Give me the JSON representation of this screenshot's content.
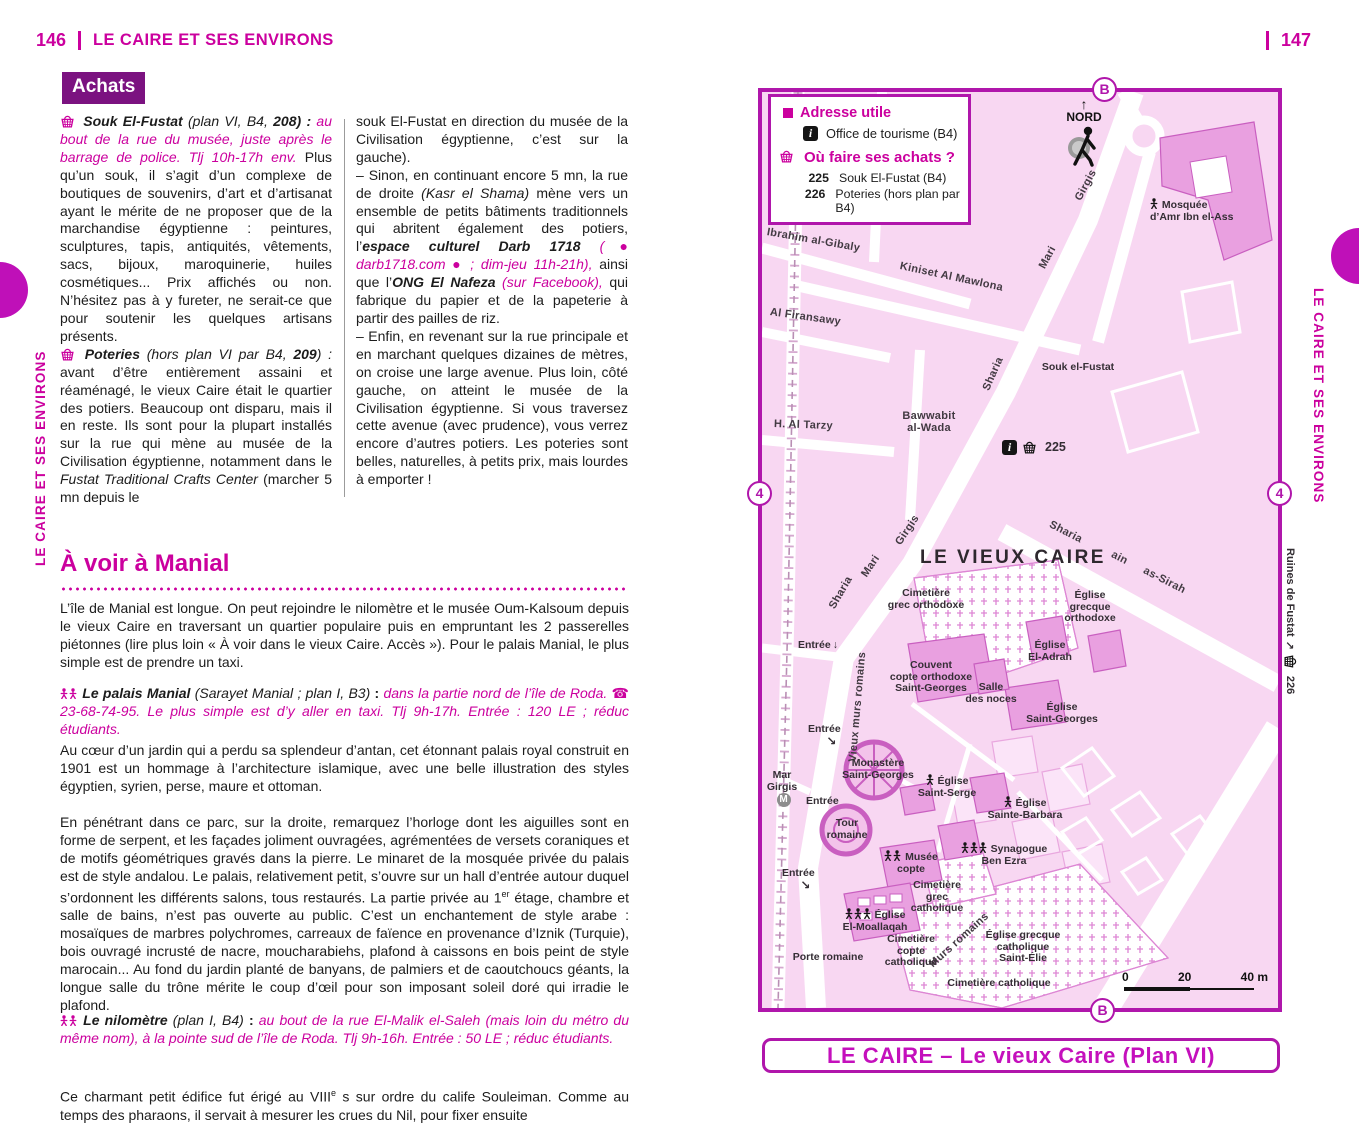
{
  "colors": {
    "accent_magenta": "#cb009e",
    "map_border": "#b016ab",
    "badge_purple": "#7b1280",
    "map_pink": "#f8d7f2"
  },
  "header_left": {
    "page": "146",
    "title": "LE CAIRE ET SES ENVIRONS"
  },
  "header_right": {
    "page": "147"
  },
  "margin_left": {
    "tab_text": "LE CAIRE ET SES ENVIRONS"
  },
  "margin_right": {
    "tab_text": "LE CAIRE ET SES ENVIRONS"
  },
  "achats": {
    "badge": "Achats",
    "col1": [
      [
        {
          "icon": "basket"
        },
        {
          "t": " Souk El-Fustat ",
          "s": "bi"
        },
        {
          "t": "(plan VI, B4, ",
          "s": "i"
        },
        {
          "t": "208",
          "s": "bi"
        },
        {
          "t": ") : ",
          "s": "bi"
        },
        {
          "t": "au bout de la rue du musée, juste après le barrage de police. Tlj 10h-17h env.",
          "s": "mi"
        },
        {
          "t": " Plus qu’un souk, il s’agit d’un complexe de boutiques de souvenirs, d’art et d’artisanat ayant le mérite de ne proposer que de la marchandise égyptienne : peintures, sculptures, tapis, antiquités, vêtements, sacs, bijoux, maroquinerie, huiles cosmétiques... Prix affichés ou non. N’hésitez pas à y fureter, ne serait-ce que pour soutenir les quelques artisans présents.",
          "s": "n"
        }
      ],
      [
        {
          "icon": "basket"
        },
        {
          "t": " Poteries ",
          "s": "bi"
        },
        {
          "t": "(hors plan VI par B4, ",
          "s": "i"
        },
        {
          "t": "209",
          "s": "bi"
        },
        {
          "t": ") : ",
          "s": "i"
        },
        {
          "t": "avant d’être entièrement assaini et réaménagé, le vieux Caire était le quartier des potiers. Beaucoup ont disparu, mais il en reste. Ils sont pour la plupart installés sur la rue qui mène au musée de la Civilisation égyptienne, notamment dans le ",
          "s": "n"
        },
        {
          "t": "Fustat Traditional Crafts Center",
          "s": "i"
        },
        {
          "t": " (marcher 5 mn depuis le",
          "s": "n"
        }
      ]
    ],
    "col2": [
      [
        {
          "t": "souk El-Fustat en direction du musée de la Civilisation égyptienne, c’est sur la gauche).",
          "s": "n"
        }
      ],
      [
        {
          "t": "– Sinon, en continuant encore 5 mn, la rue de droite ",
          "s": "n"
        },
        {
          "t": "(Kasr el Shama)",
          "s": "i"
        },
        {
          "t": " mène vers un ensemble de petits bâtiments traditionnels qui abritent également des potiers, l’",
          "s": "n"
        },
        {
          "t": "espace culturel Darb 1718",
          "s": "bi"
        },
        {
          "t": " (● darb1718.com ● ; dim-jeu 11h-21h),",
          "s": "mi"
        },
        {
          "t": " ainsi que l’",
          "s": "n"
        },
        {
          "t": "ONG El Nafeza",
          "s": "bi"
        },
        {
          "t": " (sur Facebook),",
          "s": "mi"
        },
        {
          "t": " qui fabrique du papier et de la papeterie à partir des pailles de riz.",
          "s": "n"
        }
      ],
      [
        {
          "t": "– Enfin, en revenant sur la rue principale et en marchant quelques dizaines de mètres, on croise une large avenue. Plus loin, côté gauche, on atteint le musée de la Civilisation égyptienne. Si vous traversez cette avenue (avec prudence), vous verrez encore d’autres potiers. Les poteries sont belles, naturelles, à petits prix, mais lourdes à emporter !",
          "s": "n"
        }
      ]
    ]
  },
  "manial": {
    "title": "À voir à Manial",
    "intro": [
      [
        {
          "t": "L’île de Manial est longue. On peut rejoindre le nilomètre et le musée Oum-Kalsoum depuis le vieux Caire en traversant un quartier populaire puis en empruntant les 2 passerelles piétonnes (lire plus loin « À voir dans le vieux Caire. Accès »). Pour le palais Manial, le plus simple est de prendre un taxi.",
          "s": "n"
        }
      ]
    ],
    "sight1": [
      [
        {
          "icon": "sights"
        },
        {
          "t": " Le palais Manial ",
          "s": "bi"
        },
        {
          "t": "(Sarayet Manial ; plan I, B3)",
          "s": "i"
        },
        {
          "t": " : ",
          "s": "b"
        },
        {
          "t": "dans la partie nord de l’île de Roda. ☎ 23-68-74-95. Le plus simple est d’y aller en taxi. Tlj 9h-17h. Entrée : 120 LE ; réduc étudiants.",
          "s": "mi"
        }
      ]
    ],
    "body1": [
      [
        {
          "t": "Au cœur d’un jardin qui a perdu sa splendeur d’antan, cet étonnant palais royal construit en 1901 est un hommage à l’architecture islamique, avec une belle illustration des styles égyptien, syrien, perse, maure et ottoman.",
          "s": "n"
        }
      ],
      [
        {
          "t": "En pénétrant dans ce parc, sur la droite, remarquez l’horloge dont les aiguilles sont en forme de serpent, et les façades joliment ouvragées, agrémentées de versets coraniques et de motifs géométriques gravés dans la pierre. Le minaret de la mosquée privée du palais est de style andalou. Le palais, relativement petit, s’ouvre sur un hall d’entrée autour duquel s’ordonnent les différents salons, tous restaurés. La partie privée au 1",
          "s": "n"
        },
        {
          "t": "er",
          "s": "sup"
        },
        {
          "t": " étage, chambre et salle de bains, n’est pas ouverte au public. C’est un enchantement de style arabe : mosaïques de marbres polychromes, carreaux de faïence en provenance d’Iznik (Turquie), bois ouvragé incrusté de nacre, moucharabiehs, plafond à caissons en bois peint de style marocain... Au fond du jardin planté de banyans, de palmiers et de caoutchoucs géants, la longue salle du trône mérite le coup d’œil pour son imposant soleil doré qui irradie le plafond.",
          "s": "n"
        }
      ]
    ],
    "sight2": [
      [
        {
          "icon": "sights"
        },
        {
          "t": " Le nilomètre ",
          "s": "bi"
        },
        {
          "t": "(plan I, B4)",
          "s": "i"
        },
        {
          "t": " : ",
          "s": "b"
        },
        {
          "t": "au bout de la rue El-Malik el-Saleh (mais loin du métro du même nom), à la pointe sud de l’île de Roda. Tlj 9h-16h. Entrée : 50 LE ; réduc étudiants.",
          "s": "mi"
        }
      ]
    ],
    "body2": [
      [
        {
          "t": "Ce charmant petit édifice fut érigé au VIII",
          "s": "n"
        },
        {
          "t": "e",
          "s": "sup"
        },
        {
          "t": " s sur ordre du calife Souleiman. Comme au temps des pharaons, il servait à mesurer les crues du Nil, pour fixer ensuite",
          "s": "n"
        }
      ]
    ]
  },
  "map": {
    "legend": {
      "address_title": "Adresse utile",
      "address_item": "Office de tourisme (B4)",
      "shopping_title": "Où faire ses achats ?",
      "shopping_items": [
        {
          "num": "225",
          "label": "Souk El-Fustat (B4)"
        },
        {
          "num": "226",
          "label": "Poteries (hors plan par B4)"
        }
      ]
    },
    "centre_ville_arrow": "↑",
    "centre_ville": "Centre-ville",
    "nord_arrow": "↑",
    "nord": "NORD",
    "marker_b": "B",
    "marker_4": "4",
    "scale": {
      "s0": "0",
      "s20": "20",
      "s40": "40 m"
    },
    "ruines": {
      "text": "Ruines de Fustat",
      "arrow": "↗",
      "num": "226"
    },
    "caption": "LE CAIRE – Le vieux Caire (Plan VI)",
    "labels": [
      {
        "t": "Ibrahim al-Gibaly",
        "x": 5,
        "y": 134,
        "r": 10,
        "c": "street"
      },
      {
        "t": "Kiniset  Al Mawlona",
        "x": 138,
        "y": 168,
        "r": 12,
        "c": "street"
      },
      {
        "t": "Al Firansawy",
        "x": 8,
        "y": 214,
        "r": 8,
        "c": "street"
      },
      {
        "t": "H.  Al  Tarzy",
        "x": 12,
        "y": 326,
        "r": 2,
        "c": "street"
      },
      {
        "t": "Bawwabit\nal-Wada",
        "x": 132,
        "y": 318,
        "r": 0,
        "c": "street",
        "w": 70,
        "ctr": true
      },
      {
        "t": "Girgis",
        "x": 316,
        "y": 102,
        "r": -62,
        "c": "street"
      },
      {
        "t": "Mari",
        "x": 280,
        "y": 170,
        "r": -62,
        "c": "street"
      },
      {
        "t": "Sharia",
        "x": 224,
        "y": 292,
        "r": -66,
        "c": "street"
      },
      {
        "t": "Sharia",
        "x": 288,
        "y": 426,
        "r": 27,
        "c": "street"
      },
      {
        "t": "ain",
        "x": 350,
        "y": 456,
        "r": 27,
        "c": "street"
      },
      {
        "t": "as-Sirah",
        "x": 382,
        "y": 472,
        "r": 27,
        "c": "street"
      },
      {
        "t": "Girgis",
        "x": 136,
        "y": 446,
        "r": -56,
        "c": "street"
      },
      {
        "t": "Mari",
        "x": 102,
        "y": 478,
        "r": -56,
        "c": "street"
      },
      {
        "t": "Sharia",
        "x": 70,
        "y": 510,
        "r": -60,
        "c": "street"
      },
      {
        "t": "Vieux murs romains",
        "x": 36,
        "y": 604,
        "r": -85,
        "c": "street",
        "w": 120
      },
      {
        "t": "Murs romains",
        "x": 156,
        "y": 834,
        "r": -42,
        "c": "street",
        "w": 100
      },
      {
        "t": "LE VIEUX CAIRE",
        "x": 158,
        "y": 456,
        "c": "title"
      },
      {
        "t": "Cimetière\ngrec orthodoxe",
        "x": 108,
        "y": 496,
        "c": "poi",
        "w": 112
      },
      {
        "t": "Église\ngrecque\northodoxe",
        "x": 292,
        "y": 498,
        "c": "poi",
        "w": 72
      },
      {
        "t": "Église\nEl-Adrah",
        "x": 252,
        "y": 548,
        "c": "poi",
        "w": 72
      },
      {
        "t": "Couvent\ncopte orthodoxe\nSaint-Georges",
        "x": 108,
        "y": 568,
        "c": "poi",
        "w": 122
      },
      {
        "t": "Salle\ndes noces",
        "x": 196,
        "y": 590,
        "c": "poi",
        "w": 66
      },
      {
        "t": "Église\nSaint-Georges",
        "x": 252,
        "y": 610,
        "c": "poi",
        "w": 96
      },
      {
        "t": "Monastère\nSaint-Georges",
        "x": 60,
        "y": 666,
        "c": "poi",
        "w": 112
      },
      {
        "t": "Église\nSaint-Serge",
        "x": 144,
        "y": 682,
        "c": "poi",
        "w": 82,
        "i": "p1"
      },
      {
        "t": "Église\nSainte-Barbara",
        "x": 212,
        "y": 704,
        "c": "poi",
        "w": 102,
        "i": "p1"
      },
      {
        "t": "Synagogue\nBen Ezra",
        "x": 196,
        "y": 750,
        "c": "poi",
        "w": 92,
        "i": "p3"
      },
      {
        "t": "Musée\ncopte",
        "x": 116,
        "y": 758,
        "c": "poi",
        "w": 66,
        "i": "p2"
      },
      {
        "t": "Tour\nromaine",
        "x": 54,
        "y": 726,
        "c": "poi",
        "w": 62
      },
      {
        "t": "Cimetière\ngrec\ncatholique",
        "x": 136,
        "y": 788,
        "c": "poi",
        "w": 78
      },
      {
        "t": "Église\nEl-Moallaqah",
        "x": 62,
        "y": 816,
        "c": "poi",
        "w": 102,
        "i": "p3"
      },
      {
        "t": "Cimetière\ncopte\ncatholique",
        "x": 110,
        "y": 842,
        "c": "poi",
        "w": 78
      },
      {
        "t": "Église grecque\ncatholique\nSaint-Élie",
        "x": 208,
        "y": 838,
        "c": "poi",
        "w": 106
      },
      {
        "t": "Porte romaine",
        "x": 18,
        "y": 860,
        "c": "poi",
        "w": 96
      },
      {
        "t": "Cimetière catholique",
        "x": 156,
        "y": 886,
        "c": "poi",
        "w": 162
      },
      {
        "t": "Souk el-Fustat",
        "x": 260,
        "y": 270,
        "c": "poi",
        "w": 112
      },
      {
        "t": "Mosquée\nd’Amr Ibn el-Ass",
        "x": 388,
        "y": 106,
        "c": "poi poi-left",
        "w": 120,
        "i": "p1"
      },
      {
        "t": "Mar\nGirgis",
        "x": 0,
        "y": 678,
        "c": "poi",
        "w": 40,
        "i": "metro",
        "ia": true
      },
      {
        "t": "225",
        "x": 240,
        "y": 348,
        "c": "num",
        "i": "infobasket"
      },
      {
        "t": "Entrée",
        "x": 36,
        "y": 548,
        "c": "entree",
        "ar": "↓"
      },
      {
        "t": "Entrée",
        "x": 46,
        "y": 632,
        "c": "entree",
        "arb": "↘"
      },
      {
        "t": "Entrée",
        "x": 44,
        "y": 704,
        "c": "entree"
      },
      {
        "t": "Entrée",
        "x": 20,
        "y": 776,
        "c": "entree",
        "arb": "↘"
      }
    ]
  }
}
